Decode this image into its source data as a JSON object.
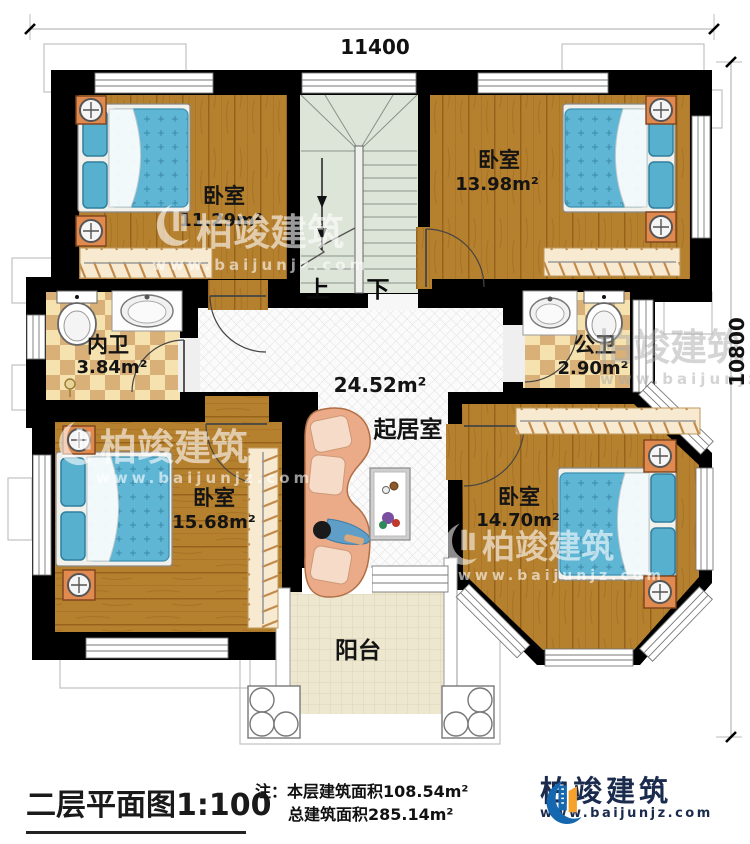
{
  "dimensions": {
    "top": "11400",
    "right": "10800"
  },
  "rooms": {
    "bedroom_tl": {
      "name": "卧室",
      "area": "11.29m²"
    },
    "bedroom_tr": {
      "name": "卧室",
      "area": "13.98m²"
    },
    "bath_inner": {
      "name": "内卫",
      "area": "3.84m²"
    },
    "bath_public": {
      "name": "公卫",
      "area": "2.90m²"
    },
    "living": {
      "name": "起居室",
      "area": "24.52m²"
    },
    "bedroom_bl": {
      "name": "卧室",
      "area": "15.68m²"
    },
    "bedroom_br": {
      "name": "卧室",
      "area": "14.70m²"
    },
    "balcony": {
      "name": "阳台"
    }
  },
  "stairs": {
    "up": "上",
    "down": "下"
  },
  "title_block": {
    "title": "二层平面图",
    "scale": "1:100",
    "note_prefix": "注：",
    "note_line1": "本层建筑面积108.54m²",
    "note_line2": "总建筑面积285.14m²"
  },
  "brand": {
    "name": "柏竣建筑",
    "url": "www.baijunjz.com"
  },
  "watermark": {
    "name": "柏竣建筑",
    "url": "www.baijunjz.com"
  },
  "colors": {
    "wall": "#000000",
    "wood": "#b6812e",
    "bed": "#5fb6d4",
    "stair": "#dde4d8",
    "checker_light": "#f5e2af",
    "checker_dark": "#d9b078",
    "balcony_tile": "#eee7cf",
    "brand_navy": "#1b2b4d",
    "brand_blue": "#1568b0",
    "brand_orange": "#f5a12b"
  }
}
